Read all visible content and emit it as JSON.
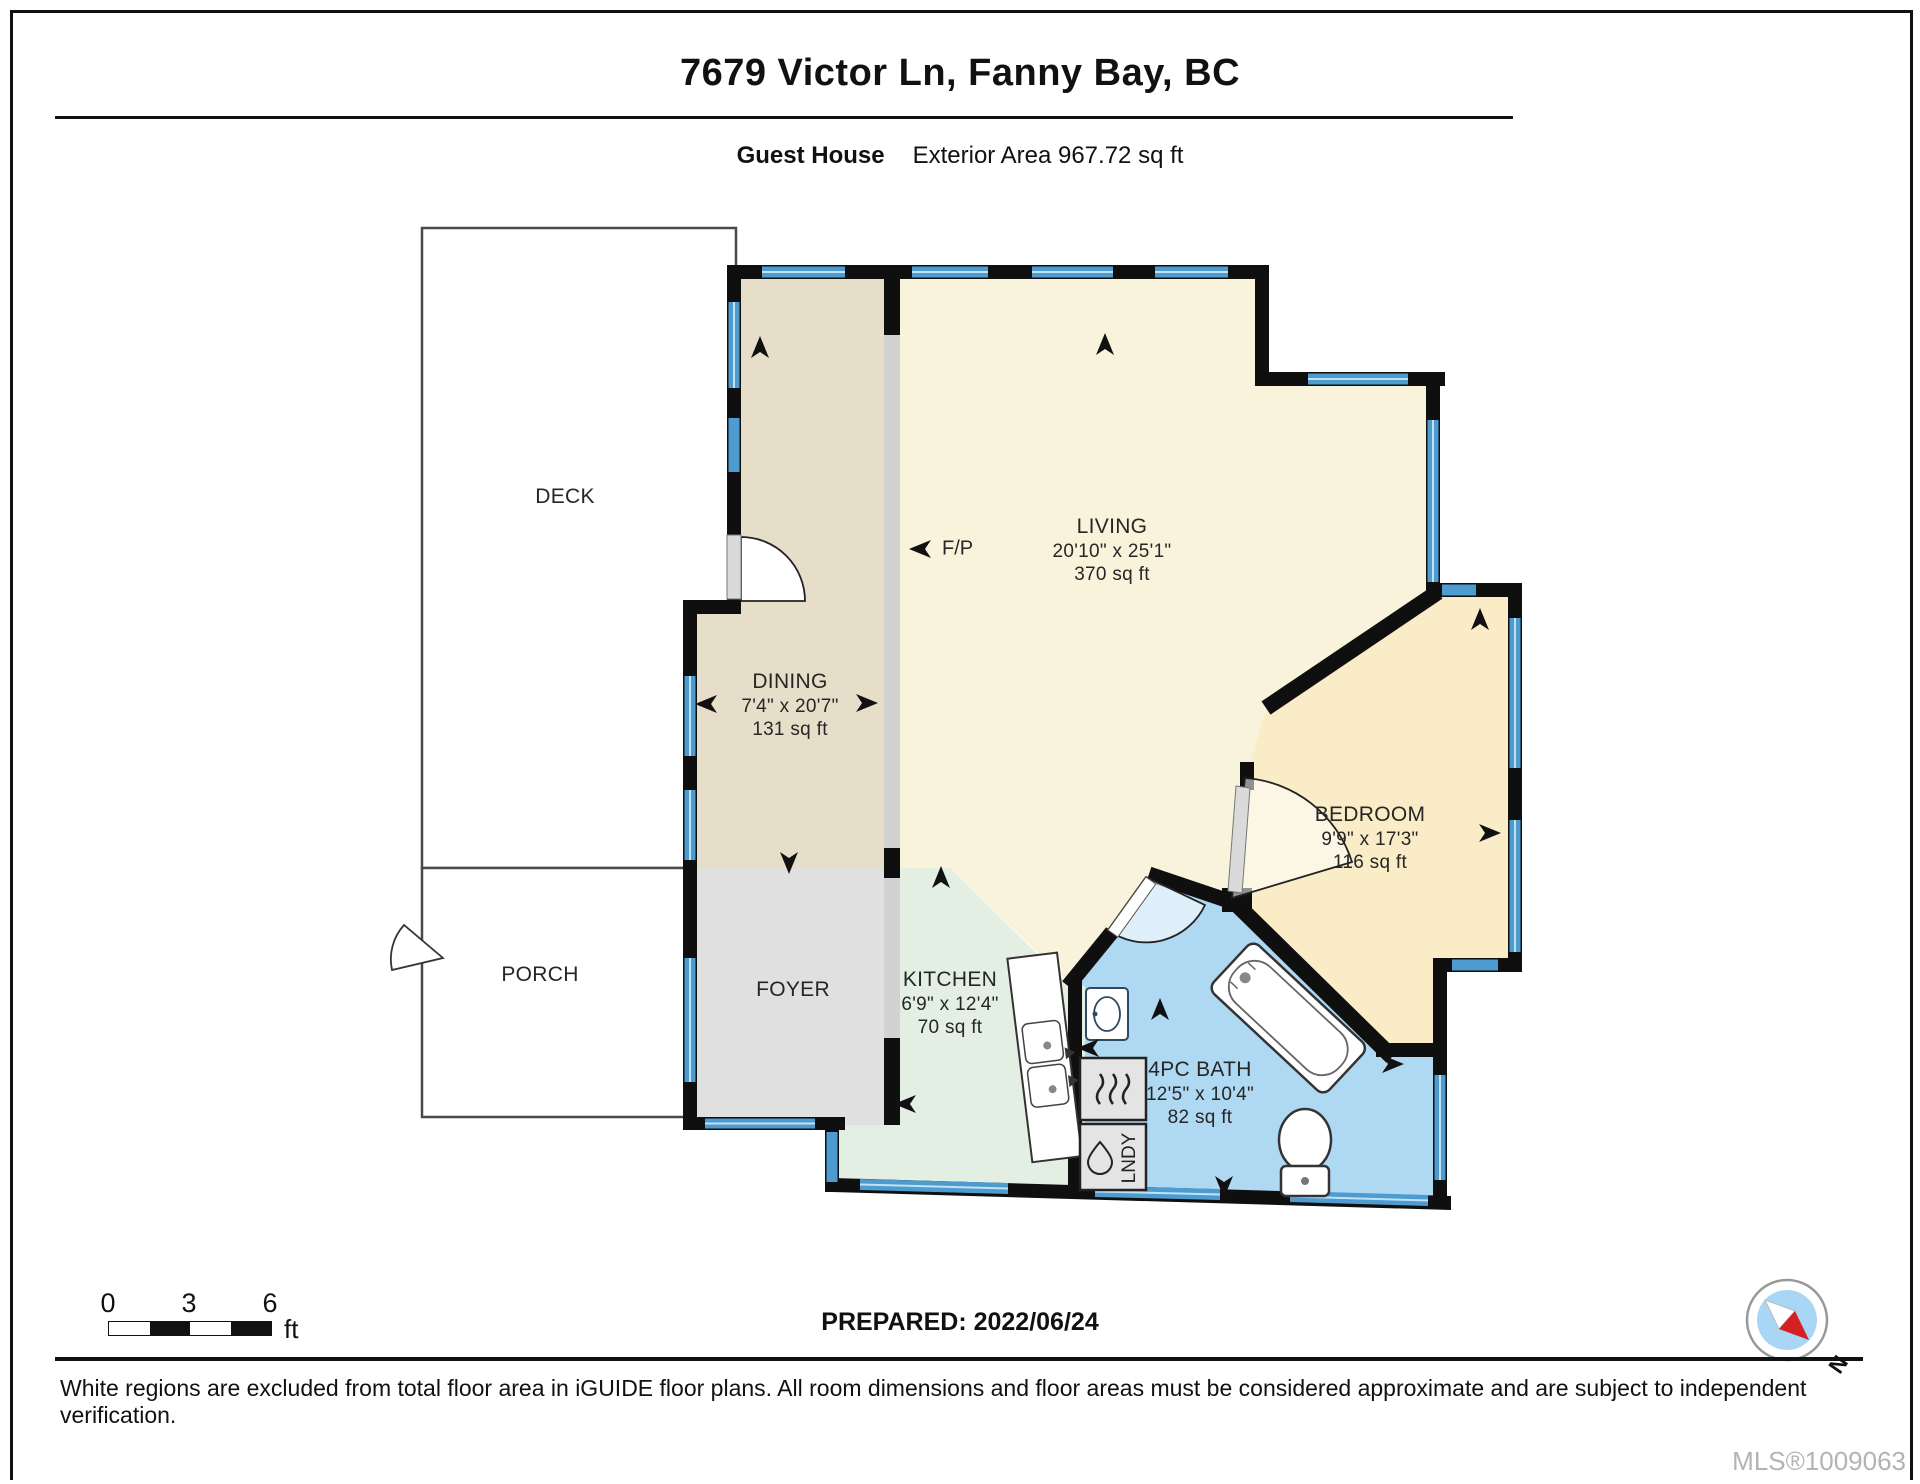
{
  "header": {
    "title": "7679 Victor Ln, Fanny Bay, BC",
    "floor": "Guest House",
    "area": "Exterior Area 967.72 sq ft"
  },
  "rooms": {
    "deck": {
      "name": "DECK"
    },
    "porch": {
      "name": "PORCH"
    },
    "foyer": {
      "name": "FOYER"
    },
    "dining": {
      "name": "DINING",
      "dims": "7'4\" x 20'7\"",
      "area": "131 sq ft"
    },
    "living": {
      "name": "LIVING",
      "dims": "20'10\" x 25'1\"",
      "area": "370 sq ft"
    },
    "kitchen": {
      "name": "KITCHEN",
      "dims": "6'9\" x 12'4\"",
      "area": "70 sq ft"
    },
    "bath": {
      "name": "4PC BATH",
      "dims": "12'5\" x 10'4\"",
      "area": "82 sq ft"
    },
    "bedroom": {
      "name": "BEDROOM",
      "dims": "9'9\" x 17'3\"",
      "area": "116 sq ft"
    }
  },
  "labels": {
    "fireplace": "F/P",
    "laundry": "LNDY"
  },
  "scale_bar": {
    "tick0": "0",
    "tick1": "3",
    "tick2": "6",
    "unit": "ft"
  },
  "compass": {
    "north": "N"
  },
  "footer": {
    "prepared": "PREPARED: 2022/06/24",
    "disclaimer": "White regions are excluded from total floor area in iGUIDE floor plans. All room dimensions and floor areas must be considered approximate and are subject to independent verification.",
    "mls": "MLS®1009063"
  },
  "colors": {
    "wall": "#0f0f0f",
    "window_blue": "#4E9BCF",
    "window_stripe": "#BFE2F5",
    "living_fill": "#FAF3DB",
    "bedroom_fill": "#F9ECC6",
    "dining_fill": "#E7DECA",
    "foyer_fill": "#E0E0E0",
    "kitchen_fill": "#E4EFE4",
    "bath_fill": "#AFD8F2",
    "compass_red": "#D42020"
  }
}
